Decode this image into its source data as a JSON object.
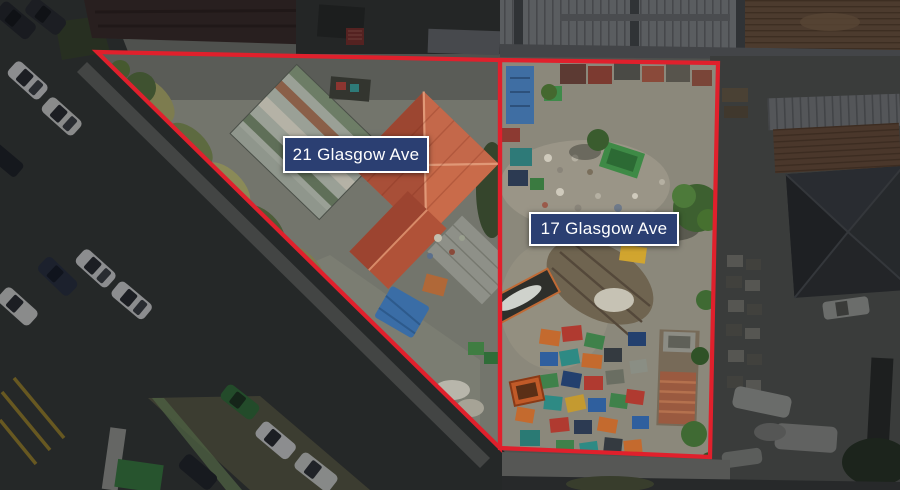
{
  "annotations": {
    "parcel_21": {
      "label": "21 Glasgow Ave",
      "points": "97,52 500,60 500,448"
    },
    "parcel_17": {
      "label": "17 Glasgow Ave",
      "points": "500,60 718,63 710,457 500,448"
    }
  },
  "colors": {
    "boundary": "#e0202c",
    "label_background": "#2b3f72",
    "label_border": "#ffffff",
    "label_text": "#ffffff"
  }
}
